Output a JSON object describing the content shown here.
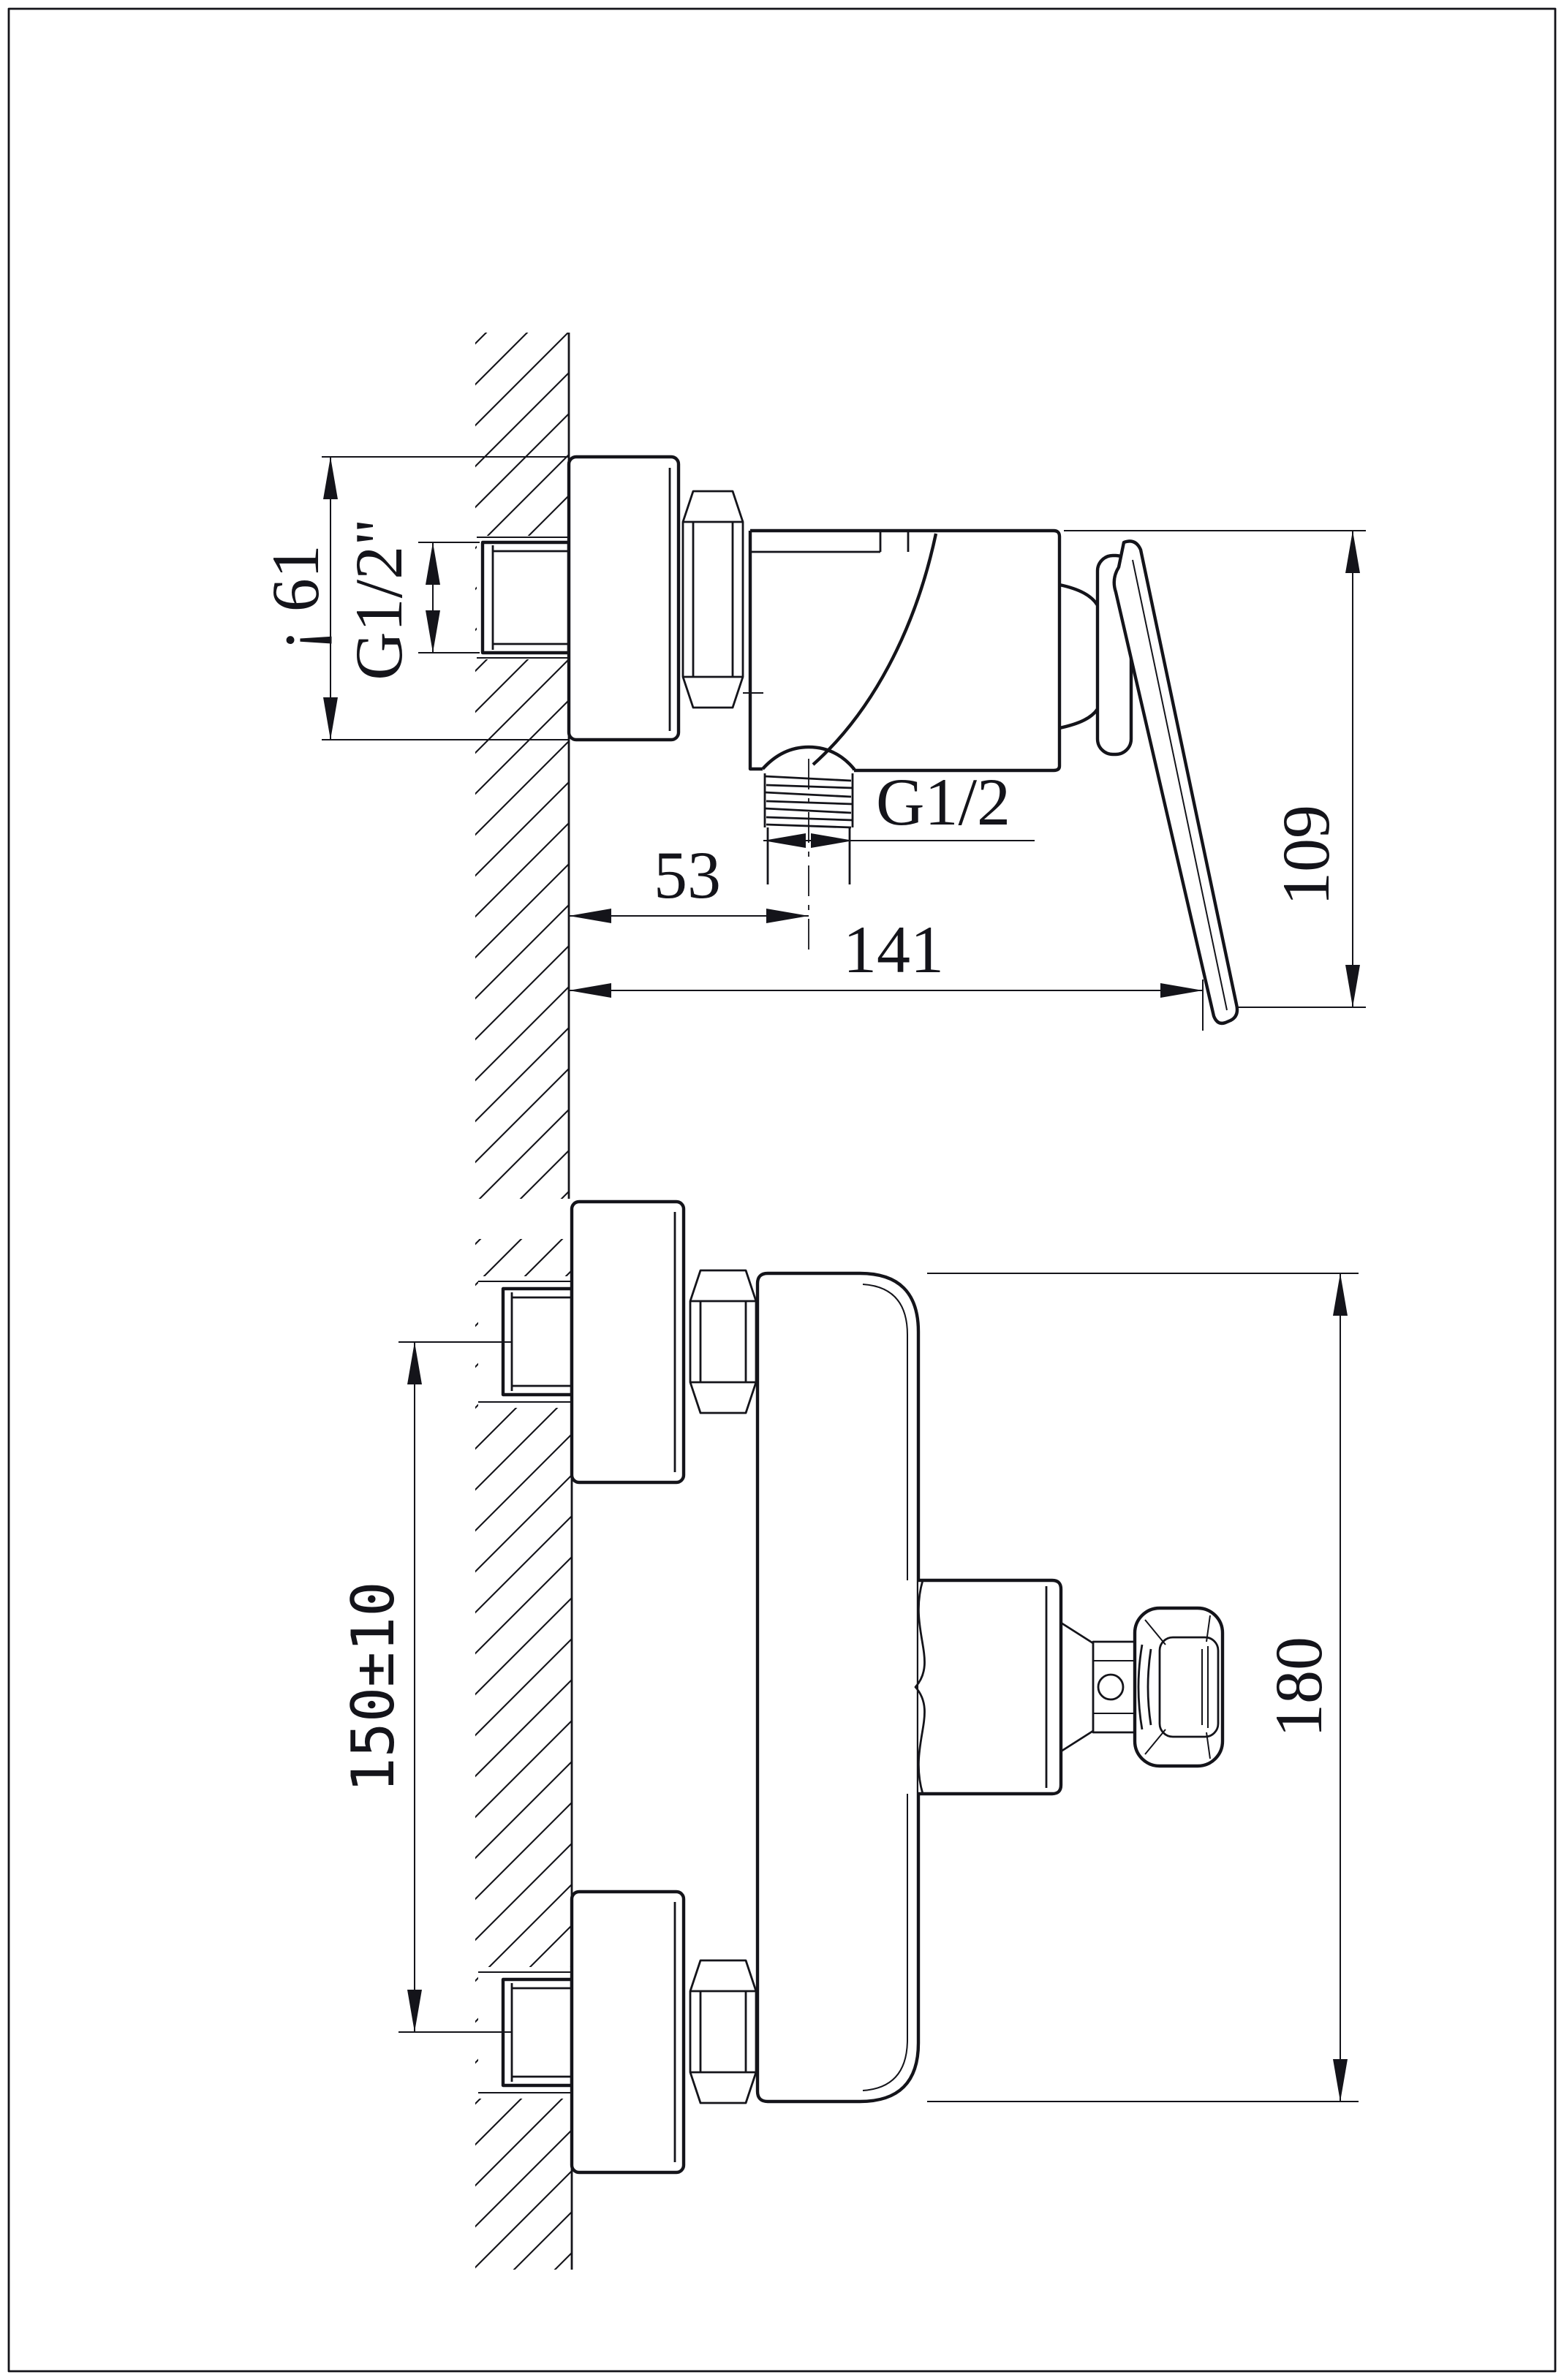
{
  "drawing": {
    "paper_color": "#ffffff",
    "ink_color": "#14141a",
    "views": {
      "side_section": {
        "title": "side section view of shower mixer on wall",
        "dims": {
          "escutcheon_height": "¡ 61",
          "inlet_thread": "G1/2\"",
          "outlet_thread": "G1/2",
          "wall_to_outlet_center": "53",
          "wall_to_handle_tip": "141",
          "overall_depth": "109"
        }
      },
      "front_view": {
        "title": "front view of shower mixer with two wall unions",
        "dims": {
          "inlet_spacing": "150±10",
          "body_height": "180"
        }
      }
    }
  }
}
